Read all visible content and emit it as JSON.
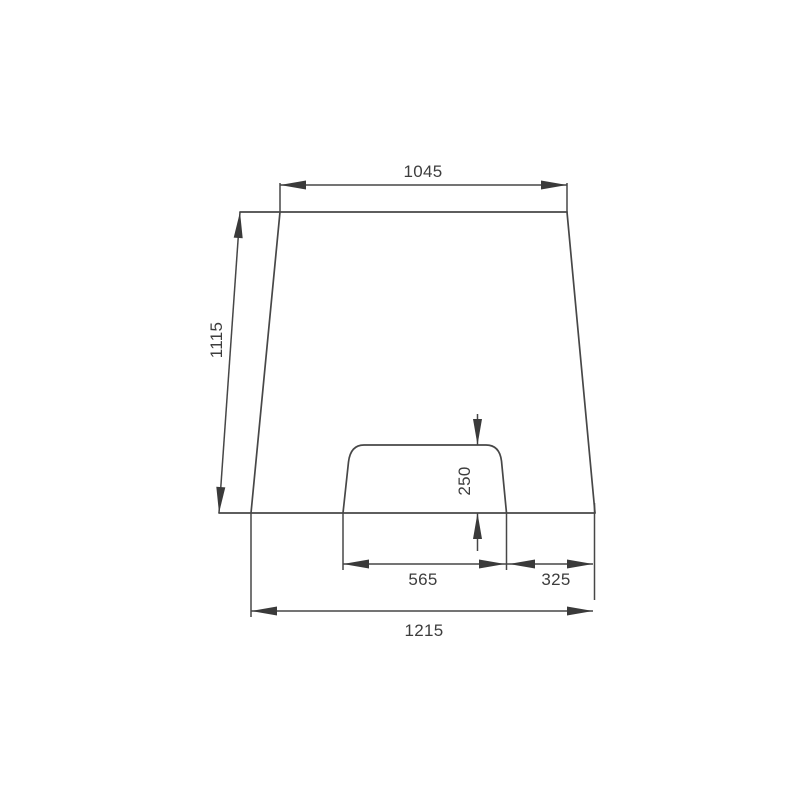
{
  "page": {
    "background_color": "#ffffff",
    "line_color": "#474747",
    "text_color": "#3d3d3d"
  },
  "drawing": {
    "type": "technical-dimension-drawing",
    "shape": "trapezoid-panel-with-bottom-notch",
    "labels": {
      "top_width": "1045",
      "side_height": "1115",
      "notch_height": "250",
      "notch_width": "565",
      "notch_right_offset": "325",
      "bottom_width": "1215"
    }
  }
}
